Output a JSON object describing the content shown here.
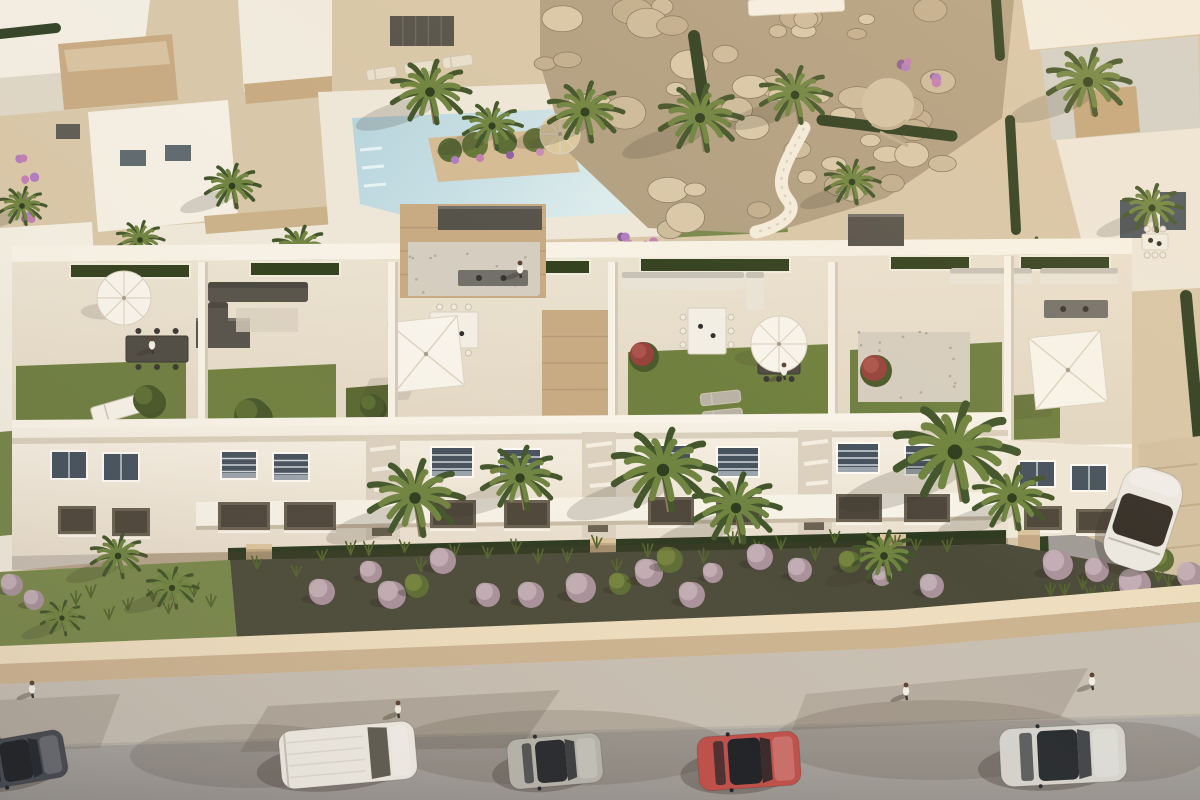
{
  "scene": {
    "title": "Aerial 3D architectural rendering of a white Mediterranean apartment complex with rooftop terraces, pool, palm gardens and a street with parked cars at golden hour",
    "type": "architectural-render-aerial"
  },
  "palette": {
    "sand": "#d8c7a8",
    "deck": "#eee7d8",
    "pool_water": "#bfdbe1",
    "pool_shallow": "#d8eaec",
    "white_wall": "#f5efe3",
    "white_top": "#f8f3e8",
    "wall_shade": "#d9cdb9",
    "stone": "#c8ab83",
    "gravel": "#d5cdbf",
    "slab_dark": "#56534b",
    "lawn": "#6e7e41",
    "lawn_bright": "#78894b",
    "hedge": "#2e3d20",
    "rock_base": "#b2a082",
    "rock_light": "#d9c8a9",
    "rock_mid": "#cdbb9b",
    "rock_dark": "#c2ae8e",
    "bed_dark": "#4c4b3a",
    "bush_lavender": "#a9929b",
    "bush_lavender_light": "#c6b2b8",
    "bush_green": "#5d6c35",
    "bush_green_light": "#78873f",
    "wall_top_band": "#eeddbe",
    "wall_face": "#cdb491",
    "sidewalk": "#c7bfb2",
    "road": "#a7a39f",
    "shadow": "#463a2e",
    "palm_dark": "#42552a",
    "palm_light": "#6f8440",
    "umbrella_white": "#f8f4eb",
    "umbrella_straw": "#dcc89e"
  },
  "top": {
    "palms": [
      [
        430,
        92,
        40
      ],
      [
        585,
        112,
        38
      ],
      [
        492,
        126,
        30
      ],
      [
        300,
        248,
        28
      ],
      [
        232,
        186,
        28
      ],
      [
        140,
        240,
        24
      ],
      [
        700,
        118,
        42
      ],
      [
        795,
        95,
        36
      ],
      [
        852,
        182,
        28
      ],
      [
        1088,
        82,
        42
      ],
      [
        1152,
        208,
        30
      ],
      [
        1032,
        258,
        26
      ],
      [
        22,
        206,
        24
      ],
      [
        30,
        346,
        22
      ]
    ],
    "rock_boxes": [
      [
        545,
        4,
        440,
        100,
        26
      ],
      [
        600,
        96,
        360,
        80,
        14
      ],
      [
        660,
        170,
        240,
        60,
        9
      ]
    ],
    "items": [
      [
        "lounger",
        366,
        70,
        30,
        11,
        -8,
        "#e9dfcb"
      ],
      [
        "lounger",
        404,
        64,
        30,
        11,
        -8,
        "#e9dfcb"
      ],
      [
        "lounger",
        442,
        58,
        30,
        11,
        -8,
        "#e9dfcb"
      ],
      [
        "pergola",
        390,
        16,
        64,
        30
      ],
      [
        "umbT",
        560,
        134,
        20
      ],
      [
        "canopy",
        748,
        0,
        96,
        16
      ],
      [
        "tableW",
        1142,
        234,
        26,
        16
      ],
      [
        "flowers",
        24,
        158
      ],
      [
        "flowers",
        30,
        178
      ],
      [
        "flowers",
        24,
        200
      ],
      [
        "flowers",
        30,
        220
      ],
      [
        "flowers",
        626,
        240
      ],
      [
        "flowers",
        650,
        244
      ],
      [
        "flowers",
        906,
        64
      ],
      [
        "flowers",
        938,
        80
      ],
      [
        "flowers",
        1048,
        352
      ],
      [
        "flowers",
        1066,
        342
      ]
    ]
  },
  "building": {
    "windows": [
      [
        52,
        452,
        34,
        26,
        "up"
      ],
      [
        104,
        454,
        34,
        26,
        "up"
      ],
      [
        222,
        452,
        34,
        26,
        "upb"
      ],
      [
        274,
        454,
        34,
        26,
        "upb"
      ],
      [
        432,
        448,
        40,
        28,
        "upb"
      ],
      [
        500,
        450,
        40,
        28,
        "upb"
      ],
      [
        650,
        446,
        40,
        28,
        "upb"
      ],
      [
        718,
        448,
        40,
        28,
        "upb"
      ],
      [
        838,
        444,
        40,
        28,
        "upb"
      ],
      [
        906,
        446,
        40,
        28,
        "upb"
      ],
      [
        1020,
        462,
        34,
        24,
        "up"
      ],
      [
        1072,
        466,
        34,
        24,
        "up"
      ],
      [
        58,
        506,
        38,
        28,
        "low"
      ],
      [
        112,
        508,
        38,
        28,
        "low"
      ],
      [
        218,
        502,
        52,
        28,
        "low"
      ],
      [
        284,
        502,
        52,
        28,
        "low"
      ],
      [
        430,
        500,
        46,
        28,
        "low"
      ],
      [
        504,
        500,
        46,
        28,
        "low"
      ],
      [
        648,
        497,
        46,
        28,
        "low"
      ],
      [
        716,
        497,
        46,
        28,
        "low"
      ],
      [
        836,
        494,
        46,
        28,
        "low"
      ],
      [
        904,
        494,
        46,
        28,
        "low"
      ],
      [
        1024,
        506,
        38,
        24,
        "low"
      ],
      [
        1076,
        509,
        38,
        24,
        "low"
      ]
    ],
    "roof_items": [
      [
        "stone",
        400,
        204,
        146,
        94
      ],
      [
        "slab",
        438,
        206,
        104,
        24
      ],
      [
        "gravel",
        408,
        242,
        132,
        54
      ],
      [
        "stone",
        542,
        310,
        76,
        106
      ],
      [
        "gravel",
        858,
        332,
        112,
        70
      ],
      [
        "slab",
        848,
        214,
        56,
        32
      ],
      [
        "slab",
        196,
        318,
        54,
        30
      ],
      [
        "sofaD",
        208,
        282,
        100,
        20
      ],
      [
        "sofaD",
        208,
        302,
        20,
        32
      ],
      [
        "rug",
        236,
        308,
        62,
        24
      ],
      [
        "sofaW",
        622,
        272,
        122,
        18
      ],
      [
        "sofaW",
        746,
        272,
        18,
        38
      ],
      [
        "sofaW",
        950,
        268,
        82,
        16
      ],
      [
        "sofaW",
        1040,
        268,
        78,
        16
      ],
      [
        "bbq",
        458,
        270,
        70,
        16
      ],
      [
        "bbq",
        1044,
        300,
        64,
        18
      ],
      [
        "tableD",
        126,
        336,
        62,
        26
      ],
      [
        "tableW",
        430,
        312,
        48,
        36
      ],
      [
        "tableW",
        688,
        308,
        38,
        46
      ],
      [
        "tableD",
        758,
        350,
        42,
        24
      ],
      [
        "umbR",
        124,
        298,
        27
      ],
      [
        "umbR",
        779,
        344,
        28
      ],
      [
        "umbS",
        426,
        354,
        70
      ],
      [
        "umbS",
        1068,
        370,
        72
      ],
      [
        "lounger",
        90,
        408,
        52,
        18,
        -16,
        "#f6f2e8"
      ],
      [
        "lounger",
        700,
        394,
        40,
        12,
        -6,
        "#b9b3a6"
      ],
      [
        "lounger",
        702,
        412,
        40,
        12,
        -6,
        "#b9b3a6"
      ],
      [
        "bushR",
        642,
        354,
        12
      ],
      [
        "bushR",
        874,
        368,
        13
      ],
      [
        "tree",
        148,
        400,
        15
      ],
      [
        "tree",
        252,
        416,
        18
      ],
      [
        "tree",
        372,
        406,
        12
      ]
    ],
    "people": [
      {
        "x": 152,
        "y": 348
      },
      {
        "x": 520,
        "y": 272
      },
      {
        "x": 784,
        "y": 374
      }
    ]
  },
  "garden": {
    "bushes": [
      [
        322,
        592,
        13
      ],
      [
        371,
        572,
        11
      ],
      [
        392,
        595,
        14
      ],
      [
        417,
        586,
        12,
        "g"
      ],
      [
        443,
        561,
        13
      ],
      [
        488,
        595,
        12
      ],
      [
        531,
        595,
        13
      ],
      [
        581,
        588,
        15
      ],
      [
        620,
        584,
        11,
        "g"
      ],
      [
        649,
        573,
        14
      ],
      [
        670,
        560,
        13,
        "g"
      ],
      [
        692,
        595,
        13
      ],
      [
        713,
        573,
        10
      ],
      [
        760,
        557,
        13
      ],
      [
        800,
        570,
        12
      ],
      [
        850,
        562,
        11,
        "g"
      ],
      [
        882,
        576,
        10
      ],
      [
        932,
        586,
        12
      ],
      [
        1058,
        565,
        15
      ],
      [
        1097,
        570,
        12
      ],
      [
        1135,
        585,
        16
      ],
      [
        1162,
        560,
        12,
        "g"
      ],
      [
        1190,
        575,
        13
      ],
      [
        12,
        585,
        11
      ],
      [
        34,
        600,
        10
      ]
    ],
    "grass_bands": [
      {
        "x0": 250,
        "x1": 960,
        "y0": 552,
        "slope": -0.018,
        "count": 26
      },
      {
        "x0": 1040,
        "x1": 1198,
        "y0": 582,
        "slope": -0.01,
        "count": 10
      },
      {
        "x0": 60,
        "x1": 220,
        "y0": 596,
        "slope": 0,
        "count": 8
      }
    ]
  },
  "street": {
    "cars": [
      {
        "name": "white-van",
        "type": "van",
        "x": 280,
        "y": 726,
        "w": 136,
        "h": 58,
        "angle": -5,
        "body": "#f0ece3",
        "glass": "#5f5c52"
      },
      {
        "name": "silver-hatchback",
        "type": "car",
        "x": 508,
        "y": 736,
        "w": 94,
        "h": 50,
        "angle": -5,
        "body": "#b6b4ab",
        "glass": "#26292d"
      },
      {
        "name": "red-hatchback",
        "type": "car",
        "x": 698,
        "y": 734,
        "w": 102,
        "h": 54,
        "angle": -4,
        "body": "#bf4f49",
        "glass": "#1d2024"
      },
      {
        "name": "light-gray-sedan",
        "type": "car",
        "x": 1000,
        "y": 726,
        "w": 126,
        "h": 58,
        "angle": -3,
        "body": "#d5d3cc",
        "glass": "#2a2d31"
      },
      {
        "name": "dark-car-corner",
        "type": "car",
        "x": -26,
        "y": 736,
        "w": 92,
        "h": 48,
        "angle": -10,
        "body": "#474a50",
        "glass": "#202327"
      },
      {
        "name": "white-car-driveway",
        "type": "carv",
        "x": 1112,
        "y": 468,
        "w": 62,
        "h": 102,
        "angle": 18,
        "body": "#ebe9e2",
        "glass": "#332e27"
      }
    ],
    "people": [
      {
        "x": 398,
        "y": 712
      },
      {
        "x": 32,
        "y": 692
      },
      {
        "x": 906,
        "y": 694
      },
      {
        "x": 1092,
        "y": 684
      }
    ],
    "shadow_blobs": [
      [
        560,
        748,
        170,
        38
      ],
      [
        934,
        740,
        160,
        40
      ],
      [
        250,
        756,
        120,
        32
      ],
      [
        1120,
        752,
        90,
        30
      ]
    ]
  },
  "front_palms": [
    [
      415,
      498,
      48
    ],
    [
      520,
      478,
      40
    ],
    [
      663,
      470,
      52
    ],
    [
      736,
      508,
      44
    ],
    [
      955,
      452,
      62
    ],
    [
      1012,
      498,
      40
    ],
    [
      884,
      556,
      32
    ],
    [
      118,
      556,
      28
    ],
    [
      172,
      588,
      26
    ],
    [
      62,
      618,
      22
    ]
  ]
}
